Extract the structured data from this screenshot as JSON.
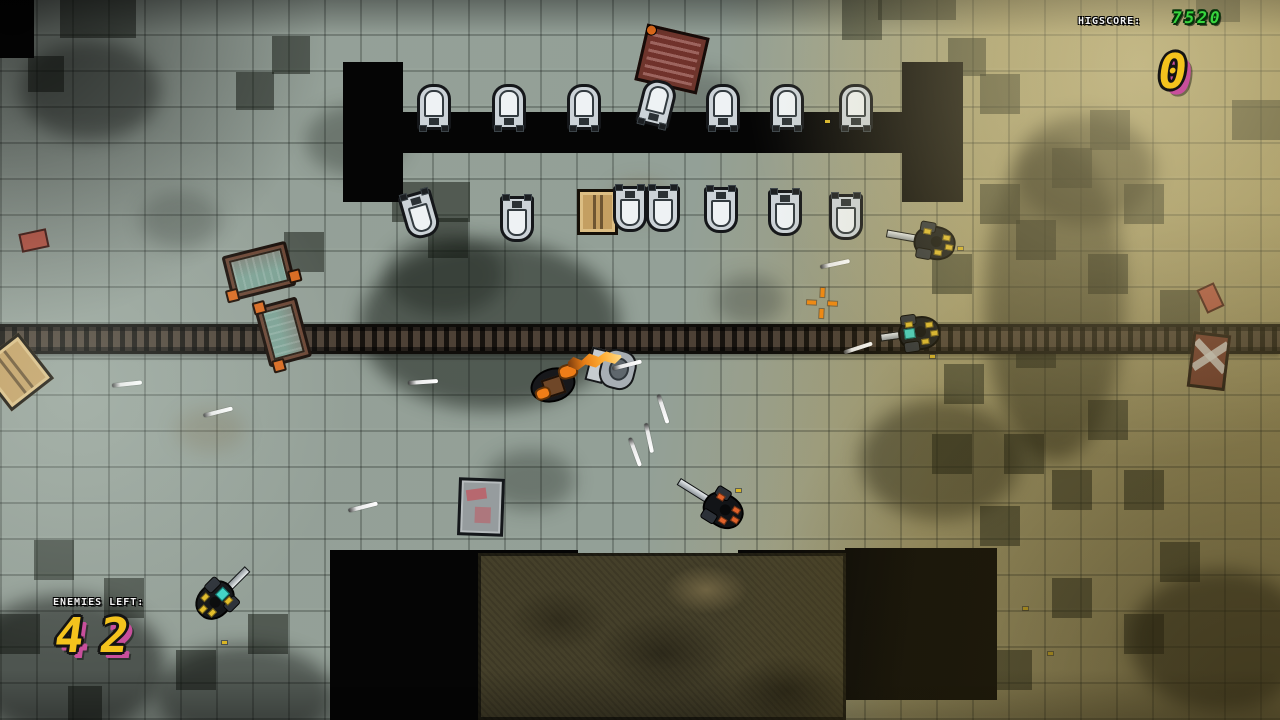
{
  "hud": {
    "highscore_label": "HIGSCORE:",
    "highscore_value": "7520",
    "score_value": "0",
    "enemies_left_label": "ENEMIES LEFT:",
    "enemies_left_value": "42",
    "colors": {
      "number_yellow": "#f4c31d",
      "number_shadow_magenta": "#c84f9c",
      "highscore_green": "#38d63e",
      "label_white": "#f2f2f2",
      "crosshair_orange": "#f28a12",
      "muzzle_orange": "#ef7d18",
      "enemy_accent_yellow": "#e3bd2a",
      "enemy_accent_orange": "#e0622a",
      "enemy_visor_teal": "#41d4c6"
    }
  },
  "scene": {
    "walls": [
      [
        343,
        62,
        60,
        140
      ],
      [
        902,
        62,
        61,
        140
      ],
      [
        343,
        112,
        620,
        41
      ],
      [
        330,
        550,
        148,
        170
      ],
      [
        845,
        548,
        152,
        152
      ],
      [
        472,
        550,
        106,
        14
      ],
      [
        738,
        550,
        108,
        14
      ],
      [
        0,
        0,
        34,
        58
      ]
    ],
    "dark_tiles": [
      [
        60,
        0,
        76,
        38
      ],
      [
        842,
        0,
        40,
        40
      ],
      [
        878,
        0,
        78,
        20
      ],
      [
        1196,
        0,
        44,
        22
      ],
      [
        28,
        56,
        36,
        36
      ],
      [
        272,
        36,
        38,
        38
      ],
      [
        236,
        72,
        38,
        38
      ],
      [
        948,
        38,
        38,
        38
      ],
      [
        1232,
        100,
        48,
        40
      ],
      [
        980,
        74,
        40,
        40
      ],
      [
        1090,
        110,
        40,
        40
      ],
      [
        392,
        182,
        78,
        40
      ],
      [
        1052,
        148,
        40,
        40
      ],
      [
        428,
        218,
        40,
        40
      ],
      [
        980,
        184,
        40,
        40
      ],
      [
        1124,
        184,
        40,
        40
      ],
      [
        284,
        232,
        40,
        40
      ],
      [
        1016,
        220,
        40,
        40
      ],
      [
        932,
        254,
        40,
        40
      ],
      [
        1088,
        254,
        40,
        40
      ],
      [
        1160,
        290,
        40,
        40
      ],
      [
        1016,
        328,
        40,
        40
      ],
      [
        944,
        364,
        40,
        40
      ],
      [
        1088,
        400,
        40,
        40
      ],
      [
        932,
        434,
        40,
        40
      ],
      [
        1004,
        434,
        40,
        40
      ],
      [
        1052,
        470,
        40,
        40
      ],
      [
        1124,
        470,
        40,
        40
      ],
      [
        980,
        506,
        40,
        40
      ],
      [
        1160,
        542,
        40,
        40
      ],
      [
        1052,
        578,
        40,
        40
      ],
      [
        1124,
        614,
        40,
        40
      ],
      [
        992,
        650,
        40,
        40
      ],
      [
        34,
        540,
        40,
        40
      ],
      [
        104,
        578,
        40,
        40
      ],
      [
        0,
        614,
        40,
        40
      ],
      [
        176,
        650,
        40,
        40
      ],
      [
        248,
        614,
        40,
        40
      ],
      [
        68,
        686,
        34,
        34
      ]
    ],
    "splotches": [
      [
        490,
        325,
        130,
        85,
        "rgba(14,19,14,0.5)"
      ],
      [
        445,
        275,
        60,
        40,
        "rgba(14,19,14,0.35)"
      ],
      [
        1055,
        300,
        70,
        160,
        "rgba(24,24,12,0.5)"
      ],
      [
        1085,
        170,
        70,
        55,
        "rgba(24,24,12,0.5)"
      ],
      [
        940,
        460,
        80,
        60,
        "rgba(24,24,14,0.45)"
      ],
      [
        65,
        665,
        100,
        70,
        "rgba(8,10,8,0.5)"
      ],
      [
        245,
        695,
        90,
        50,
        "rgba(8,10,8,0.45)"
      ],
      [
        355,
        140,
        50,
        35,
        "rgba(18,22,18,0.3)"
      ],
      [
        700,
        100,
        40,
        30,
        "rgba(18,22,18,0.25)"
      ],
      [
        530,
        480,
        45,
        30,
        "rgba(18,22,18,0.3)"
      ],
      [
        750,
        300,
        35,
        25,
        "rgba(18,22,18,0.25)"
      ],
      [
        180,
        220,
        40,
        28,
        "rgba(18,22,18,0.22)"
      ],
      [
        1220,
        640,
        90,
        70,
        "rgba(12,12,6,0.5)"
      ],
      [
        90,
        90,
        70,
        50,
        "rgba(13,16,13,0.4)"
      ],
      [
        640,
        200,
        30,
        20,
        "rgba(110,85,45,0.25)"
      ],
      [
        210,
        430,
        35,
        22,
        "rgba(110,85,45,0.2)"
      ]
    ],
    "urinals_top": [
      {
        "x": 417,
        "y": 84,
        "rot": 0
      },
      {
        "x": 492,
        "y": 84,
        "rot": 0
      },
      {
        "x": 567,
        "y": 84,
        "rot": 0
      },
      {
        "x": 640,
        "y": 80,
        "rot": 14
      },
      {
        "x": 706,
        "y": 84,
        "rot": 0
      },
      {
        "x": 770,
        "y": 84,
        "rot": 0
      },
      {
        "x": 839,
        "y": 84,
        "rot": 0
      }
    ],
    "urinals_bottom": [
      {
        "x": 403,
        "y": 192,
        "rot": -16
      },
      {
        "x": 500,
        "y": 196,
        "rot": 0
      },
      {
        "x": 613,
        "y": 186,
        "rot": 0
      },
      {
        "x": 646,
        "y": 186,
        "rot": 0
      },
      {
        "x": 704,
        "y": 187,
        "rot": 0
      },
      {
        "x": 768,
        "y": 190,
        "rot": 0
      },
      {
        "x": 829,
        "y": 194,
        "rot": 0
      }
    ],
    "props": [
      {
        "type": "crate-red",
        "x": 640,
        "y": 30,
        "w": 58,
        "h": 52,
        "rot": 13
      },
      {
        "type": "crate-wood",
        "x": 577,
        "y": 189,
        "w": 35,
        "h": 40,
        "rot": 0
      },
      {
        "type": "crate-wood",
        "x": -12,
        "y": 343,
        "w": 48,
        "h": 52,
        "rot": -38
      },
      {
        "type": "cart",
        "x": 226,
        "y": 248,
        "w": 66,
        "h": 46,
        "rot": -14
      },
      {
        "type": "cart",
        "x": 252,
        "y": 310,
        "w": 62,
        "h": 44,
        "rot": 75
      },
      {
        "type": "crate-metal",
        "x": 458,
        "y": 478,
        "w": 40,
        "h": 52,
        "rot": 2
      },
      {
        "type": "barrel-red",
        "x": 1190,
        "y": 333,
        "w": 32,
        "h": 50,
        "rot": 7
      },
      {
        "type": "debris-red",
        "x": 1201,
        "y": 285,
        "w": 15,
        "h": 22,
        "rot": -25
      },
      {
        "type": "debris-red",
        "x": 20,
        "y": 231,
        "w": 24,
        "h": 15,
        "rot": -12
      },
      {
        "type": "toilet",
        "x": 588,
        "y": 348,
        "w": 48,
        "h": 40,
        "rot": 14
      }
    ],
    "enemies": [
      {
        "x": 900,
        "y": 222,
        "rot": 10,
        "barrel": 30,
        "visor": false,
        "accent": "#e3bd2a"
      },
      {
        "x": 884,
        "y": 314,
        "rot": -8,
        "barrel": 20,
        "visor": true,
        "accent": "#e3bd2a"
      },
      {
        "x": 690,
        "y": 488,
        "rot": 32,
        "barrel": 34,
        "visor": false,
        "accent": "#e0622a"
      },
      {
        "x": 190,
        "y": 580,
        "rot": 135,
        "barrel": 26,
        "visor": true,
        "accent": "#e3bd2a"
      }
    ],
    "player": {
      "x": 528,
      "y": 356
    },
    "bullets": [
      [
        820,
        262,
        -12
      ],
      [
        843,
        346,
        -18
      ],
      [
        612,
        363,
        -14
      ],
      [
        648,
        407,
        72
      ],
      [
        634,
        436,
        78
      ],
      [
        620,
        450,
        70
      ],
      [
        408,
        380,
        -4
      ],
      [
        112,
        382,
        -6
      ],
      [
        203,
        410,
        -14
      ],
      [
        348,
        505,
        -14
      ]
    ],
    "casings": [
      [
        958,
        247
      ],
      [
        930,
        355
      ],
      [
        736,
        489
      ],
      [
        222,
        641
      ],
      [
        1023,
        607
      ],
      [
        1048,
        652
      ],
      [
        825,
        120
      ]
    ],
    "crosshair": {
      "x": 805,
      "y": 286
    }
  }
}
